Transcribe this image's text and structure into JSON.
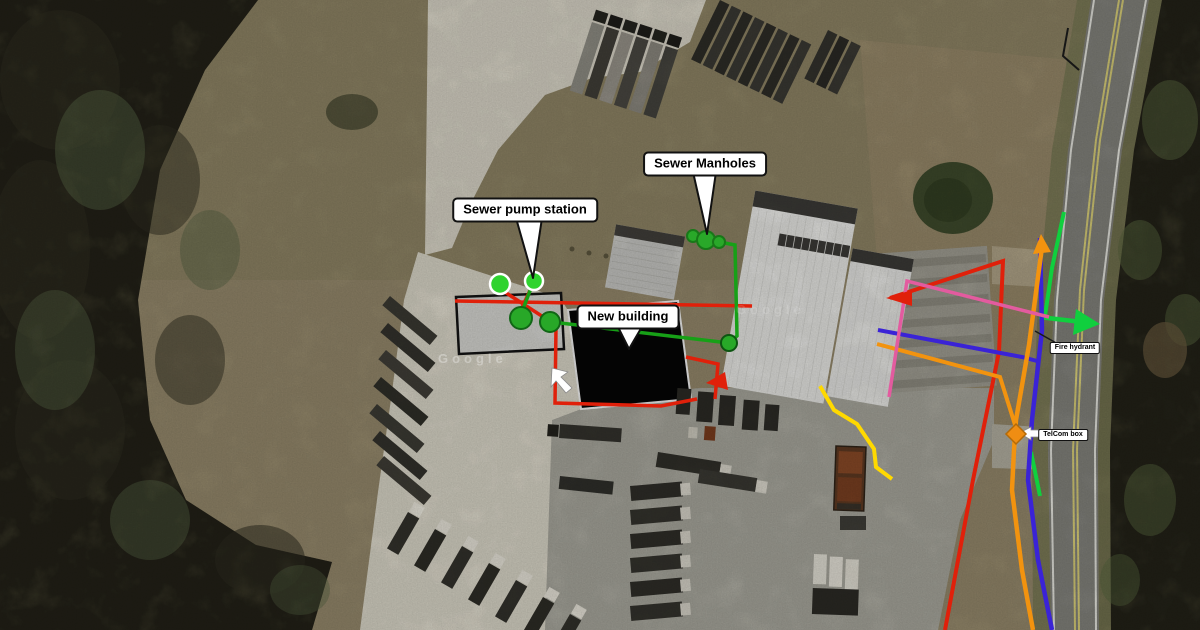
{
  "annotations": {
    "labels": [
      {
        "id": "sewer-manholes",
        "text": "Sewer Manholes",
        "x": 705,
        "y": 164,
        "size": "large"
      },
      {
        "id": "sewer-pump-station",
        "text": "Sewer pump station",
        "x": 525,
        "y": 210,
        "size": "large"
      },
      {
        "id": "new-building",
        "text": "New building",
        "x": 628,
        "y": 317,
        "size": "large"
      },
      {
        "id": "fire-hydrant",
        "text": "Fire hydrant",
        "x": 1075,
        "y": 348,
        "size": "small"
      },
      {
        "id": "telcom-box",
        "text": "TelCom box",
        "x": 1063,
        "y": 435,
        "size": "small"
      }
    ],
    "callout_tails": [
      {
        "label": "sewer-manholes",
        "points": "693,172 716,172 707,234"
      },
      {
        "label": "sewer-pump-station",
        "points": "516,218 542,218 533,278"
      },
      {
        "label": "new-building",
        "points": "617,325 643,325 629,349"
      }
    ],
    "watermark": {
      "text": "Google"
    }
  },
  "palette": {
    "red": "#e0200a",
    "green": "#17a017",
    "bright_green": "#10cf3e",
    "blue": "#3a23d6",
    "orange": "#f2930f",
    "pink": "#e35b9f",
    "yellow": "#ffd900"
  },
  "utility_lines": [
    {
      "name": "red-main-road-line",
      "color": "red",
      "width": 4,
      "points": [
        [
          890,
          298
        ],
        [
          1003,
          261
        ],
        [
          999,
          352
        ],
        [
          973,
          480
        ],
        [
          945,
          630
        ]
      ]
    },
    {
      "name": "red-line-west",
      "color": "red",
      "width": 3.5,
      "points": [
        [
          455,
          301
        ],
        [
          752,
          306
        ]
      ]
    },
    {
      "name": "red-line-pump-a",
      "color": "red",
      "width": 3.5,
      "points": [
        [
          497,
          287
        ],
        [
          551,
          322
        ]
      ]
    },
    {
      "name": "red-line-pump-b",
      "color": "red",
      "width": 3.5,
      "points": [
        [
          534,
          282
        ],
        [
          518,
          316
        ]
      ]
    },
    {
      "name": "red-line-new-building-perimeter",
      "color": "red",
      "width": 3.5,
      "points": [
        [
          556,
          327
        ],
        [
          555,
          403
        ],
        [
          661,
          406
        ],
        [
          697,
          399
        ]
      ]
    },
    {
      "name": "red-line-building-east",
      "color": "red",
      "width": 3.5,
      "points": [
        [
          686,
          357
        ],
        [
          718,
          364
        ],
        [
          715,
          399
        ]
      ]
    },
    {
      "name": "green-sewer-manhole-line",
      "color": "green",
      "width": 3.5,
      "points": [
        [
          709,
          240
        ],
        [
          735,
          245
        ],
        [
          737,
          336
        ],
        [
          730,
          342
        ]
      ]
    },
    {
      "name": "green-sewer-building-line",
      "color": "green",
      "width": 3.5,
      "points": [
        [
          552,
          322
        ],
        [
          729,
          343
        ]
      ]
    },
    {
      "name": "green-sewer-pump-line",
      "color": "green",
      "width": 3.5,
      "points": [
        [
          533,
          283
        ],
        [
          523,
          309
        ],
        [
          521,
          317
        ]
      ]
    },
    {
      "name": "green-roadside-line-upper",
      "color": "bright_green",
      "width": 4,
      "points": [
        [
          1064,
          212
        ],
        [
          1052,
          268
        ],
        [
          1045,
          316
        ]
      ]
    },
    {
      "name": "green-roadside-line-lower",
      "color": "bright_green",
      "width": 4,
      "points": [
        [
          1031,
          452
        ],
        [
          1040,
          496
        ]
      ]
    },
    {
      "name": "green-arrow-line",
      "color": "bright_green",
      "width": 4.5,
      "points": [
        [
          1039,
          317
        ],
        [
          1082,
          322
        ]
      ]
    },
    {
      "name": "blue-service-line",
      "color": "blue",
      "width": 4,
      "points": [
        [
          878,
          330
        ],
        [
          1022,
          357
        ],
        [
          1037,
          361
        ]
      ]
    },
    {
      "name": "blue-roadside-line",
      "color": "blue",
      "width": 4.5,
      "points": [
        [
          1040,
          238
        ],
        [
          1042,
          330
        ],
        [
          1032,
          420
        ],
        [
          1028,
          480
        ],
        [
          1038,
          560
        ],
        [
          1052,
          630
        ]
      ]
    },
    {
      "name": "orange-roadside-line",
      "color": "orange",
      "width": 4.5,
      "points": [
        [
          1042,
          247
        ],
        [
          1029,
          345
        ],
        [
          1016,
          420
        ],
        [
          1014,
          450
        ],
        [
          1012,
          490
        ],
        [
          1022,
          570
        ],
        [
          1033,
          630
        ]
      ]
    },
    {
      "name": "orange-service-line",
      "color": "orange",
      "width": 4,
      "points": [
        [
          877,
          344
        ],
        [
          1000,
          377
        ],
        [
          1016,
          428
        ]
      ]
    },
    {
      "name": "pink-line",
      "color": "pink",
      "width": 3.5,
      "points": [
        [
          1049,
          317
        ],
        [
          907,
          281
        ],
        [
          889,
          397
        ]
      ]
    },
    {
      "name": "yellow-line",
      "color": "yellow",
      "width": 4,
      "points": [
        [
          820,
          386
        ],
        [
          834,
          410
        ],
        [
          857,
          424
        ],
        [
          874,
          449
        ],
        [
          876,
          467
        ],
        [
          892,
          479
        ]
      ]
    },
    {
      "name": "fire-hydrant-connector",
      "color": "#1a1a1a",
      "width": 1.5,
      "points": [
        [
          1035,
          331
        ],
        [
          1058,
          344
        ]
      ]
    }
  ],
  "arrows": [
    {
      "name": "red-arrow-west",
      "color": "red",
      "points": "912,290 912,306 886,298"
    },
    {
      "name": "red-arrow-building",
      "color": "red",
      "points": "725,372 728,390 706,383"
    },
    {
      "name": "green-arrow-head",
      "color": "bright_green",
      "points": "1076,309 1073,335 1100,324"
    },
    {
      "name": "orange-arrow-head",
      "color": "orange",
      "points": "1033,254 1051,252 1041,234"
    }
  ],
  "white_arrows": [
    {
      "name": "cursor-arrow",
      "points": "552,368 568,372 561,377 572,388 566,393 556,381 551,387"
    },
    {
      "name": "telcom-arrow",
      "points": "1019,433 1031,427 1031,430 1043,430 1043,437 1031,437 1031,440"
    }
  ],
  "markers": {
    "sewer_manhole_markers": {
      "fill": "#29a829",
      "stroke": "#187818",
      "circles": [
        [
          693,
          236,
          6
        ],
        [
          706,
          240,
          9
        ],
        [
          719,
          242,
          6
        ]
      ]
    },
    "pump_station_upper_markers": {
      "fill": "#2fd32f",
      "stroke": "#ffffff",
      "circles": [
        [
          500,
          284,
          10
        ],
        [
          534,
          281,
          9
        ]
      ]
    },
    "pump_station_main_markers": {
      "fill": "#28a828",
      "stroke": "#116616",
      "circles": [
        [
          521,
          318,
          11
        ],
        [
          550,
          322,
          10
        ]
      ]
    },
    "building_connection_marker": {
      "fill": "#28a828",
      "stroke": "#0d5511",
      "circles": [
        [
          729,
          343,
          8
        ]
      ]
    },
    "telcom_box_marker": {
      "type": "diamond",
      "fill": "#ef8d13",
      "stroke": "#b36a08",
      "cx": 1016,
      "cy": 434,
      "r": 10
    }
  }
}
